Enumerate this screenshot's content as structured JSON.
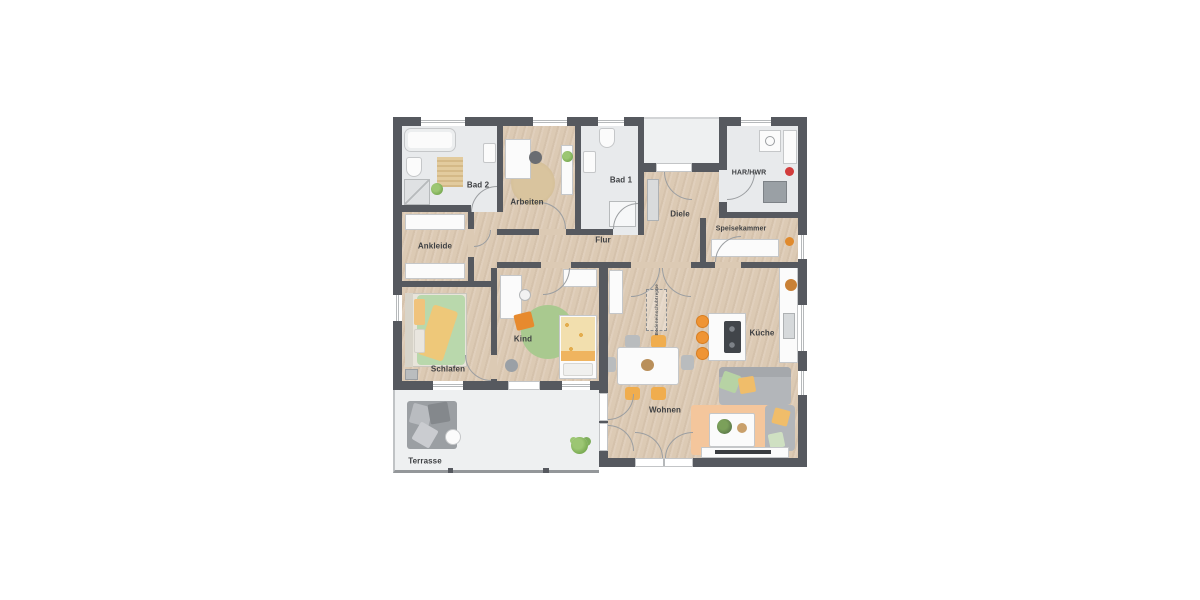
{
  "rooms": {
    "bad2": "Bad 2",
    "arbeiten": "Arbeiten",
    "bad1": "Bad 1",
    "diele": "Diele",
    "har_hwr": "HAR/HWR",
    "speisekammer": "Speisekammer",
    "ankleide": "Ankleide",
    "flur": "Flur",
    "schlafen": "Schlafen",
    "kind": "Kind",
    "wohnen": "Wohnen",
    "kueche": "Küche",
    "terrasse": "Terrasse"
  },
  "annotations": {
    "attic_stairs": "Bodeneinschubtreppe"
  },
  "colors": {
    "wall": "#56595f",
    "wood_floor": "#dccab4",
    "tile_floor": "#e8eaec",
    "outdoor_floor": "#eef0f1",
    "accent_orange": "#ef9434",
    "accent_green": "#a9c98f"
  }
}
